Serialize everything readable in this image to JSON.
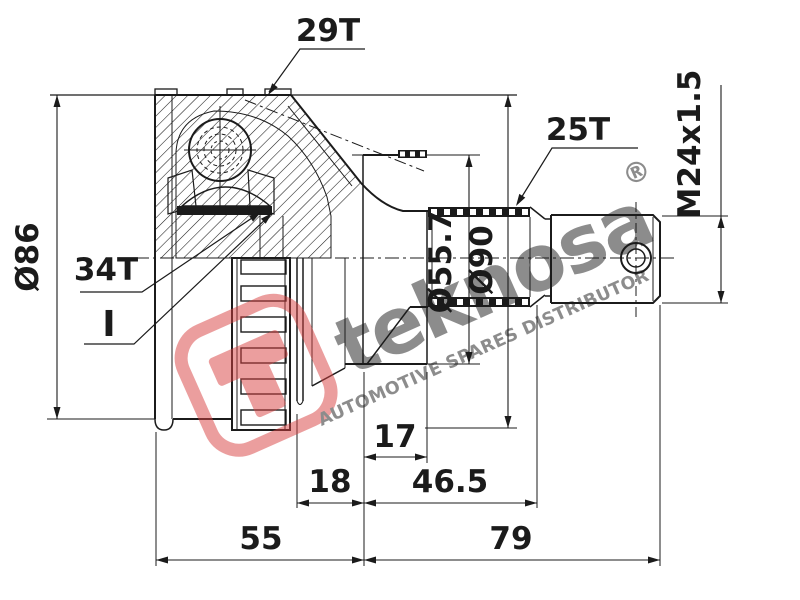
{
  "drawing": {
    "labels": {
      "outer_teeth": "29T",
      "shaft_teeth": "25T",
      "inner_teeth": "34T",
      "detail_marker": "I",
      "thread_spec": "M24x1.5",
      "housing_dia": "Ø86",
      "seat_dia": "Ø55.7",
      "ring_dia": "Ø90"
    },
    "dimensions": {
      "seat_length": "17",
      "groove_length": "18",
      "shaft_length": "46.5",
      "housing_length": "55",
      "stub_total_length": "79"
    }
  },
  "watermark": {
    "brand": "teknosa",
    "registered_mark": "®",
    "tagline": "AUTOMOTIVE SPARES DISTRIBUTOR",
    "color": "#d84040"
  },
  "colors": {
    "ink": "#1b1b1b",
    "paper": "#ffffff"
  }
}
